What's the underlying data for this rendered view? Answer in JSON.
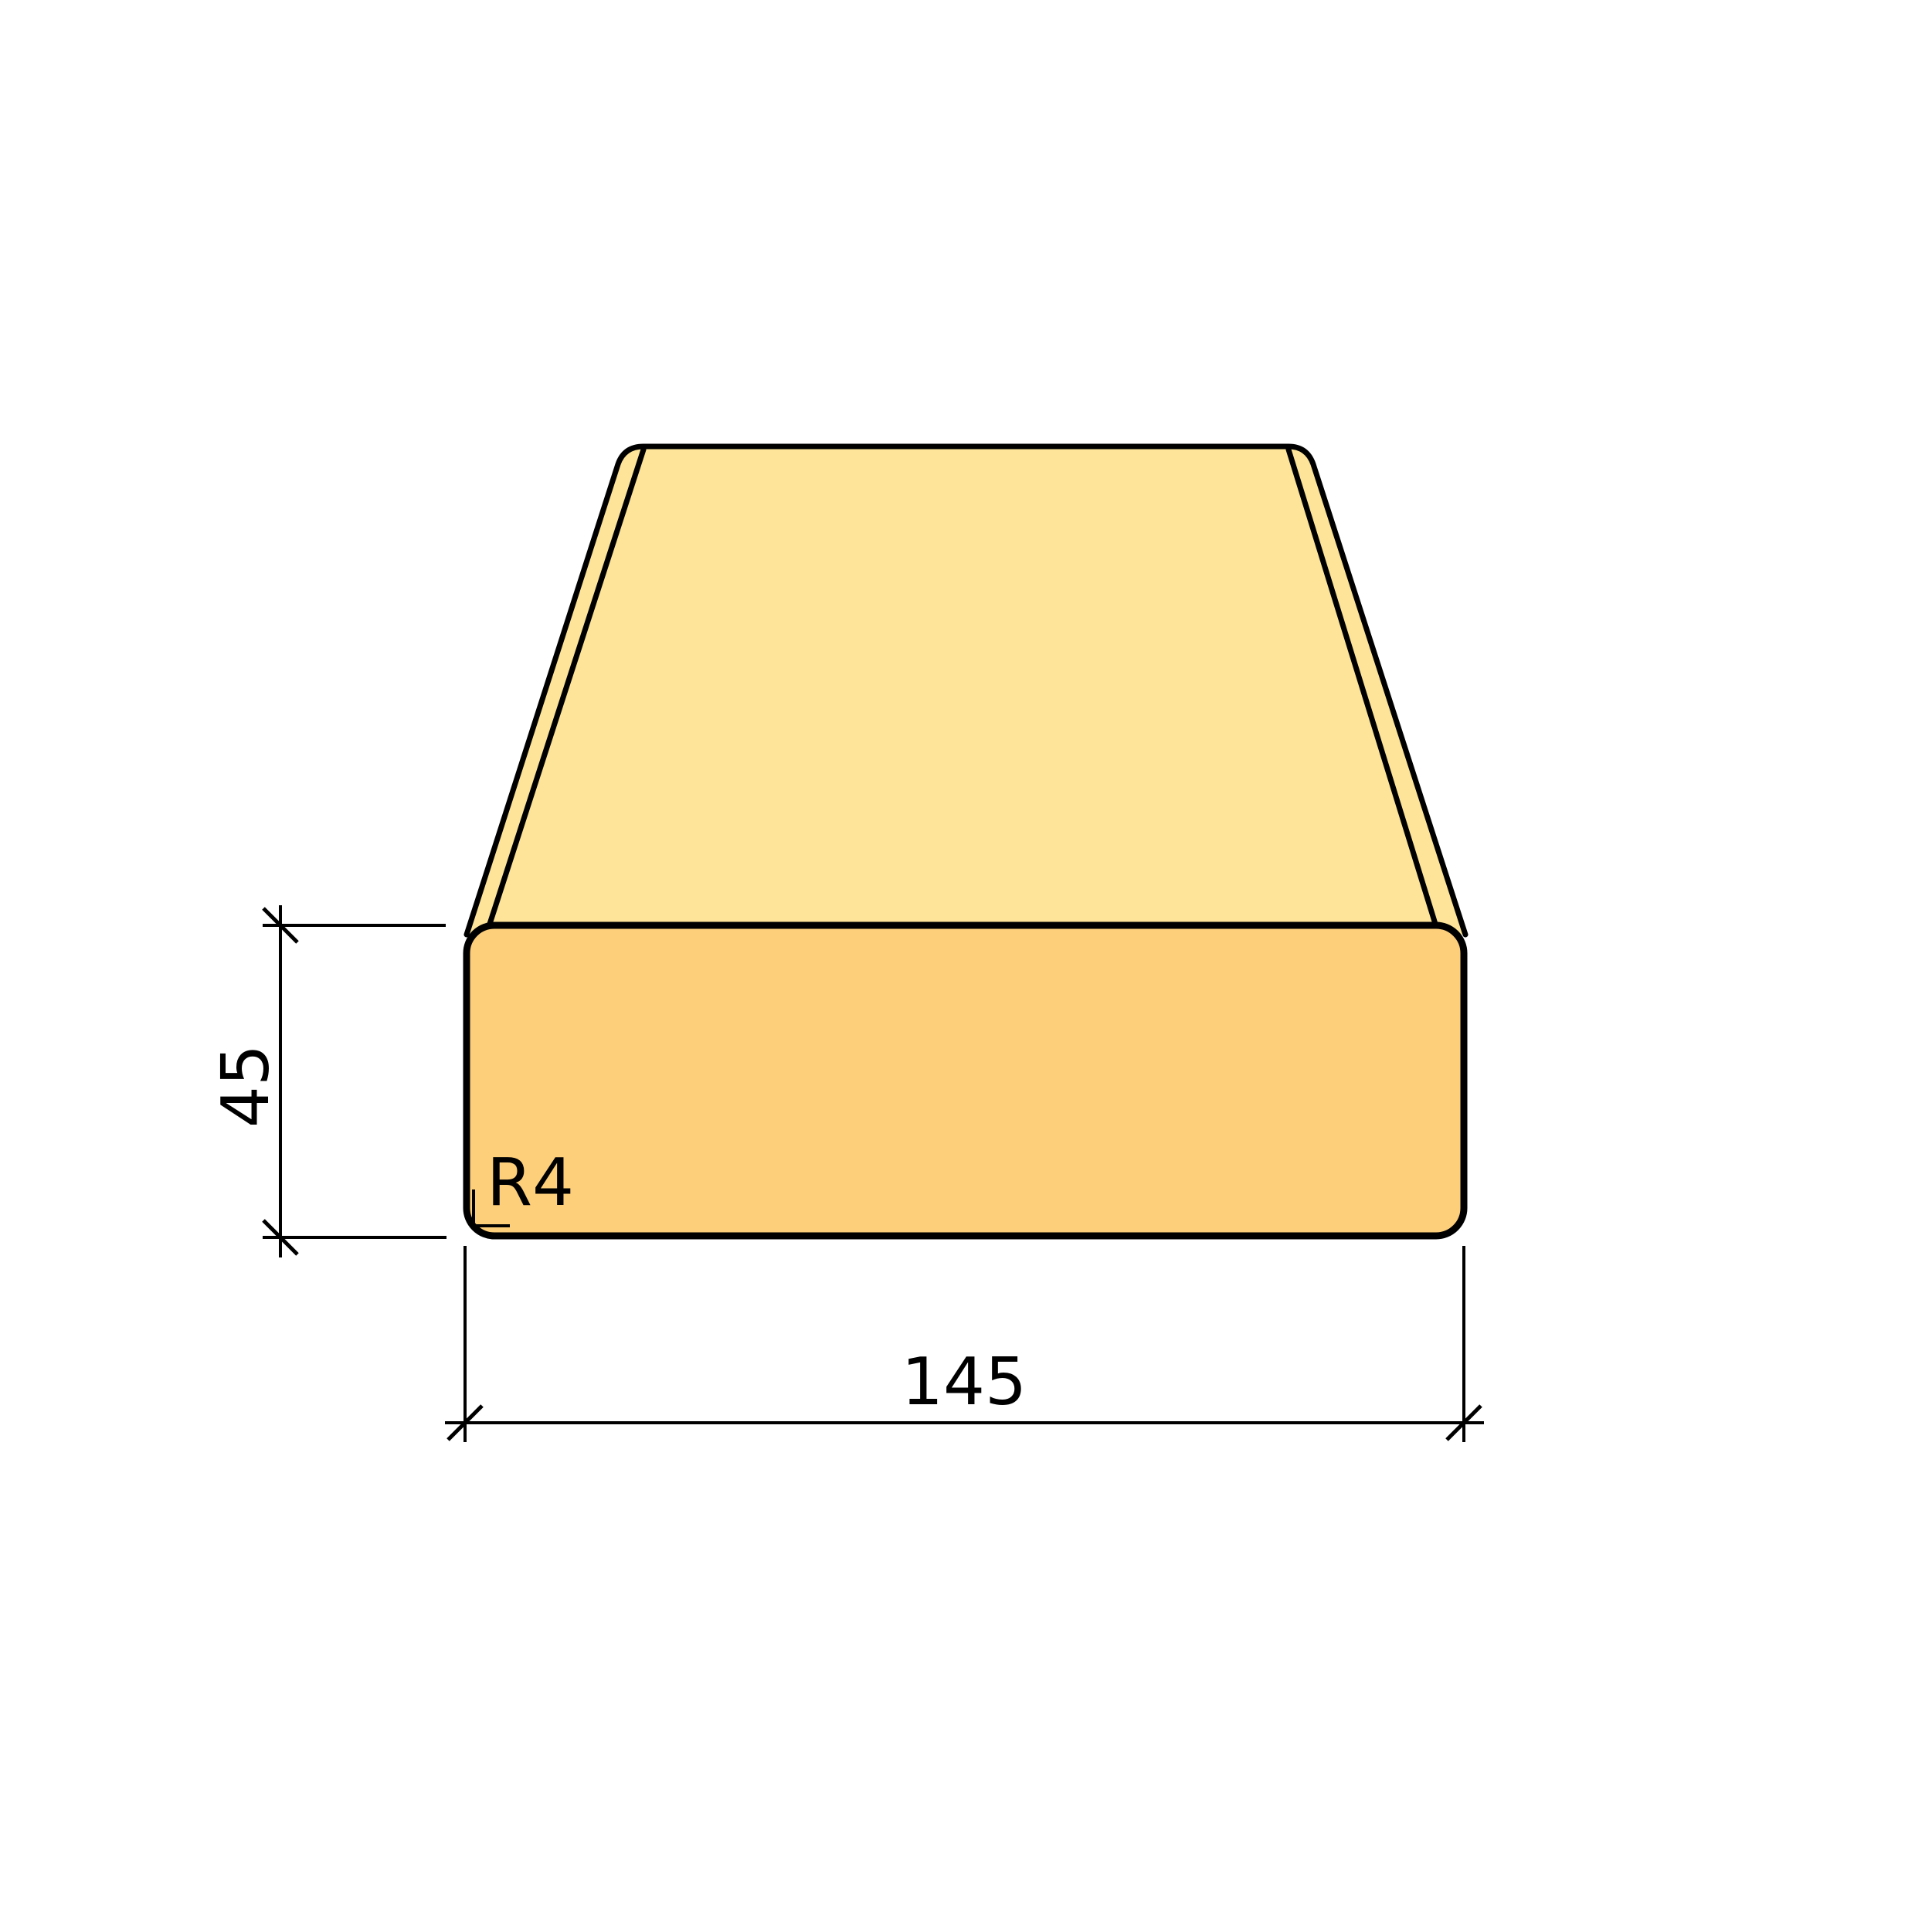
{
  "drawing": {
    "labels": {
      "height_dimension": "45",
      "width_dimension": "145",
      "corner_radius": "R4"
    },
    "colors": {
      "top_face": "#FDE498",
      "front_face": "#FDCF7B",
      "line": "#000000",
      "background": "#FFFFFF"
    }
  }
}
